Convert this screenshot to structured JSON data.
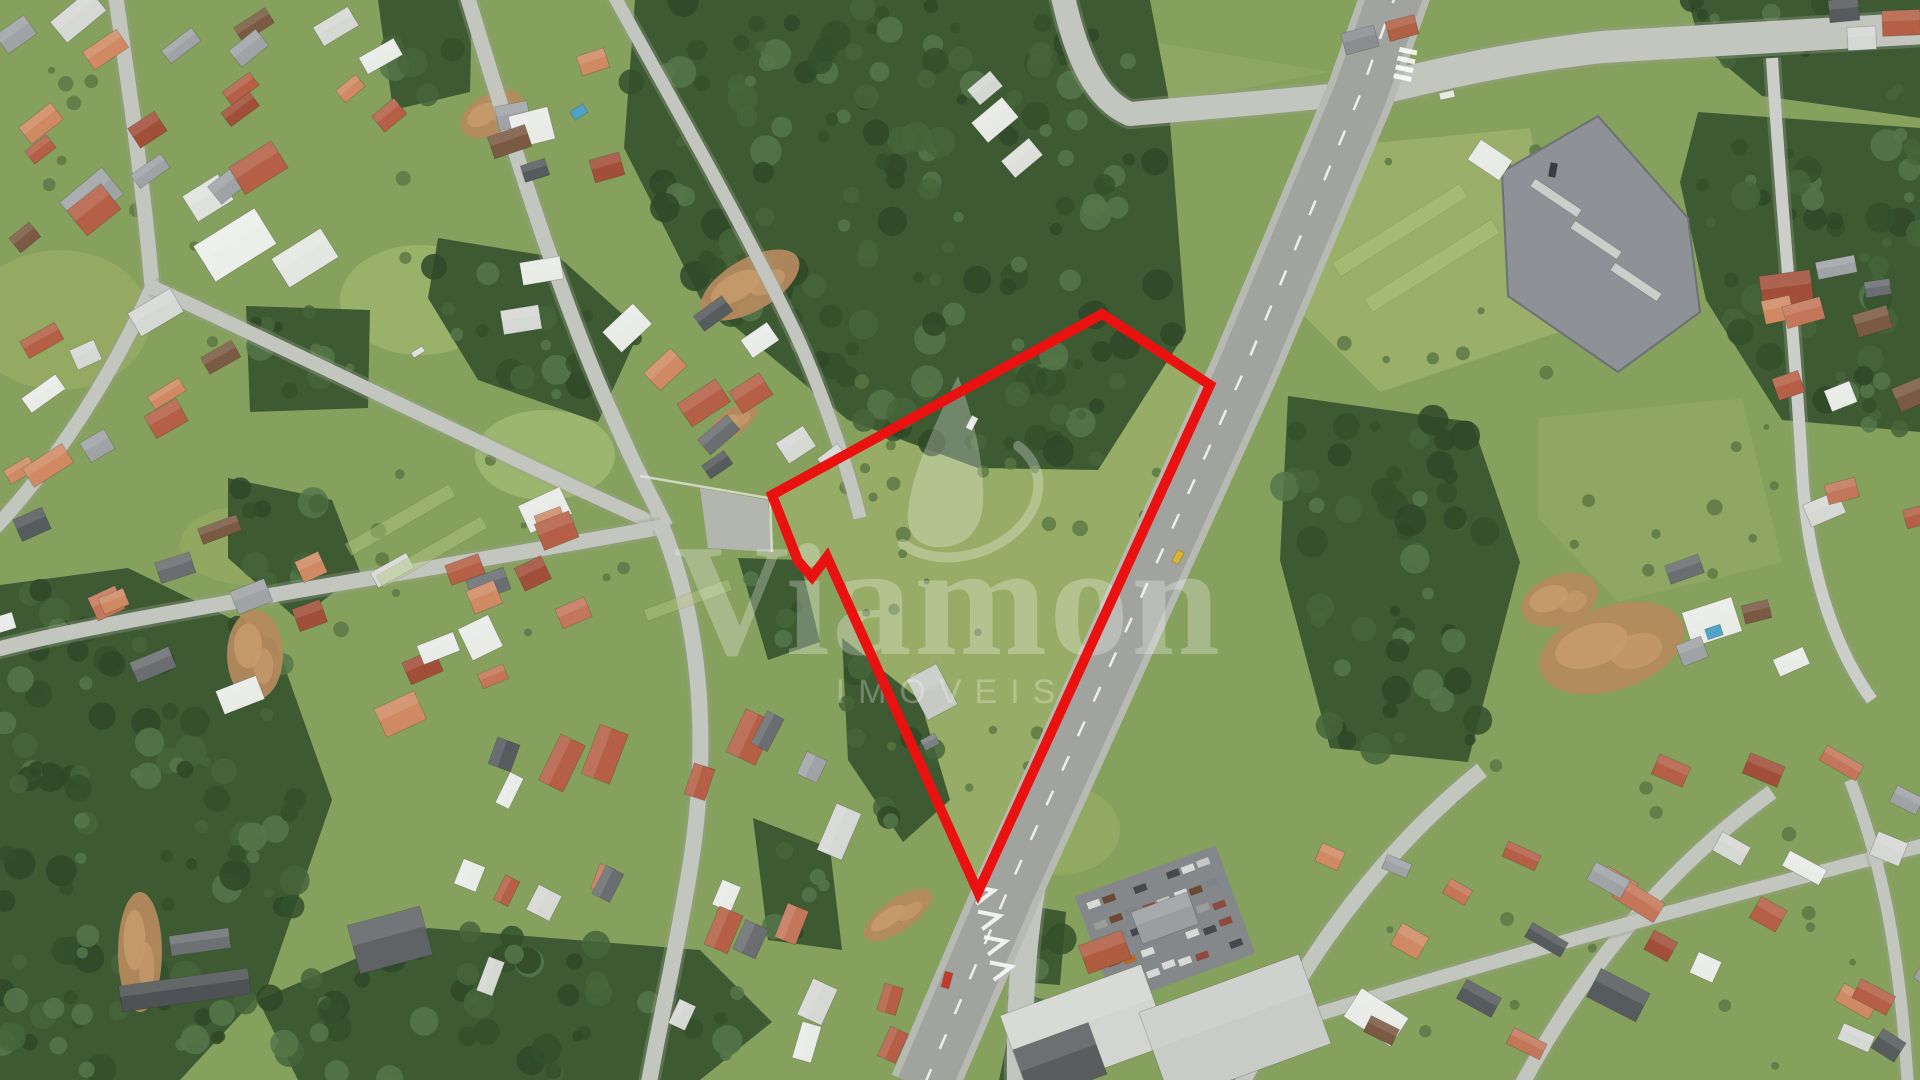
{
  "watermark": {
    "brand": "Viamon",
    "subtext": "IMÓVEIS",
    "color": "#ffffff",
    "opacity": 0.27
  },
  "boundary": {
    "color": "#ea1111",
    "stroke_width": 10,
    "points": [
      [
        1102,
        314
      ],
      [
        1210,
        385
      ],
      [
        978,
        892
      ],
      [
        827,
        557
      ],
      [
        812,
        577
      ],
      [
        798,
        561
      ],
      [
        772,
        495
      ]
    ]
  },
  "scene": {
    "base_color": "#86a05e",
    "forest_fill": "#3d5a33",
    "forest_texture": [
      "#2f4828",
      "#47653a",
      "#55774a",
      "#33502b"
    ],
    "road_color": "#c3c5bf",
    "highway_color": "#a1a49e",
    "highway_shoulder": "#b7bab2",
    "dirt_color": "#b78a5e",
    "dirt_light": "#c79b6c",
    "bush_color": "#5a7542",
    "house_palette": [
      "#b45f46",
      "#b45f46",
      "#c4765a",
      "#a14f38",
      "#e9ebe7",
      "#e9ebe7",
      "#d6d8d4",
      "#9fa3a5",
      "#6a6e71",
      "#565b5e",
      "#7a5a42",
      "#cf8a64"
    ],
    "car_palette": [
      "#d8d9d7",
      "#d8d9d7",
      "#c6c7c5",
      "#9c9d9b",
      "#8e4a3e",
      "#46494c",
      "#46494c",
      "#6b4a35",
      "#b4692e",
      "#7e8486"
    ],
    "fields": [
      {
        "use_boundary": true,
        "fill": "#97ad67"
      },
      {
        "pts": [
          [
            1300,
            150
          ],
          [
            1530,
            128
          ],
          [
            1565,
            330
          ],
          [
            1380,
            392
          ],
          [
            1288,
            300
          ]
        ],
        "fill": "#9ab06a"
      },
      {
        "pts": [
          [
            1538,
            418
          ],
          [
            1742,
            398
          ],
          [
            1782,
            562
          ],
          [
            1618,
            602
          ],
          [
            1538,
            518
          ]
        ],
        "fill": "#90a763"
      },
      {
        "pts": [
          [
            1072,
            28
          ],
          [
            1330,
            72
          ],
          [
            1140,
            108
          ]
        ],
        "fill": "#8fa765"
      },
      {
        "ellipse": [
          60,
          320,
          90,
          70
        ],
        "fill": "#96ab64"
      },
      {
        "ellipse": [
          420,
          300,
          80,
          55
        ],
        "fill": "#9cb26c"
      },
      {
        "ellipse": [
          545,
          455,
          70,
          45
        ],
        "fill": "#a0b871"
      },
      {
        "ellipse": [
          250,
          545,
          70,
          40
        ],
        "fill": "#93a862"
      },
      {
        "ellipse": [
          130,
          830,
          90,
          65
        ],
        "fill": "#8ea25f"
      },
      {
        "ellipse": [
          1060,
          830,
          60,
          45
        ],
        "fill": "#93aa63"
      }
    ],
    "forests": [
      {
        "pts": [
          [
            635,
            0
          ],
          [
            1150,
            0
          ],
          [
            1168,
            95
          ],
          [
            1186,
            332
          ],
          [
            1098,
            470
          ],
          [
            978,
            468
          ],
          [
            848,
            420
          ],
          [
            700,
            298
          ],
          [
            624,
            148
          ]
        ]
      },
      {
        "pts": [
          [
            1688,
            0
          ],
          [
            1920,
            0
          ],
          [
            1920,
            118
          ],
          [
            1762,
            96
          ],
          [
            1700,
            44
          ]
        ]
      },
      {
        "pts": [
          [
            1698,
            112
          ],
          [
            1920,
            128
          ],
          [
            1920,
            432
          ],
          [
            1782,
            420
          ],
          [
            1706,
            300
          ],
          [
            1680,
            182
          ]
        ]
      },
      {
        "pts": [
          [
            1288,
            396
          ],
          [
            1472,
            422
          ],
          [
            1520,
            562
          ],
          [
            1468,
            762
          ],
          [
            1330,
            748
          ],
          [
            1280,
            560
          ]
        ]
      },
      {
        "pts": [
          [
            0,
            585
          ],
          [
            128,
            568
          ],
          [
            275,
            640
          ],
          [
            332,
            800
          ],
          [
            268,
            985
          ],
          [
            180,
            1080
          ],
          [
            0,
            1080
          ]
        ]
      },
      {
        "pts": [
          [
            258,
            1000
          ],
          [
            428,
            928
          ],
          [
            700,
            950
          ],
          [
            772,
            1022
          ],
          [
            700,
            1080
          ],
          [
            298,
            1080
          ]
        ]
      },
      {
        "pts": [
          [
            842,
            638
          ],
          [
            920,
            700
          ],
          [
            950,
            800
          ],
          [
            903,
            842
          ],
          [
            848,
            760
          ]
        ]
      },
      {
        "pts": [
          [
            738,
            558
          ],
          [
            800,
            560
          ],
          [
            820,
            642
          ],
          [
            768,
            660
          ]
        ]
      },
      {
        "pts": [
          [
            753,
            818
          ],
          [
            830,
            848
          ],
          [
            842,
            950
          ],
          [
            768,
            940
          ]
        ]
      },
      {
        "pts": [
          [
            1026,
            905
          ],
          [
            1066,
            912
          ],
          [
            1060,
            985
          ],
          [
            1022,
            982
          ]
        ]
      },
      {
        "pts": [
          [
            1018,
            988
          ],
          [
            1062,
            1010
          ],
          [
            1056,
            1085
          ],
          [
            998,
            1085
          ]
        ]
      },
      {
        "pts": [
          [
            228,
            478
          ],
          [
            332,
            500
          ],
          [
            360,
            572
          ],
          [
            298,
            620
          ],
          [
            228,
            558
          ]
        ]
      },
      {
        "pts": [
          [
            438,
            238
          ],
          [
            560,
            258
          ],
          [
            640,
            330
          ],
          [
            598,
            422
          ],
          [
            478,
            380
          ],
          [
            428,
            298
          ]
        ]
      },
      {
        "pts": [
          [
            378,
            0
          ],
          [
            472,
            0
          ],
          [
            470,
            92
          ],
          [
            393,
            110
          ]
        ]
      },
      {
        "pts": [
          [
            246,
            306
          ],
          [
            370,
            310
          ],
          [
            368,
            408
          ],
          [
            250,
            412
          ]
        ]
      }
    ],
    "dirt": [
      [
        750,
        285,
        55,
        26,
        -30
      ],
      [
        255,
        655,
        28,
        45,
        0
      ],
      [
        140,
        952,
        22,
        60,
        0
      ],
      [
        1612,
        648,
        75,
        42,
        -18
      ],
      [
        898,
        915,
        40,
        16,
        -35
      ],
      [
        492,
        114,
        34,
        20,
        -30
      ],
      [
        733,
        422,
        28,
        13,
        -35
      ],
      [
        1560,
        600,
        40,
        25,
        -20
      ]
    ],
    "bush_zones": [
      [
        830,
        380,
        330,
        420,
        26
      ],
      [
        1300,
        140,
        260,
        260,
        12
      ],
      [
        1545,
        400,
        250,
        200,
        10
      ],
      [
        0,
        60,
        420,
        400,
        16
      ],
      [
        330,
        450,
        330,
        200,
        10
      ],
      [
        1250,
        750,
        650,
        320,
        16
      ]
    ],
    "roads": [
      {
        "d": "M612,-8 C660,80 730,200 788,318 C818,378 848,468 860,518",
        "w": 13
      },
      {
        "d": "M115,-8 C128,80 143,180 152,287",
        "w": 15
      },
      {
        "d": "M152,287 C112,375 58,460 -5,528",
        "w": 14
      },
      {
        "d": "M152,287 C280,345 480,445 662,527",
        "w": 14
      },
      {
        "d": "M466,-8 C505,120 558,298 618,428 C640,478 656,506 666,527",
        "w": 15
      },
      {
        "d": "M-5,650 C120,616 400,576 662,527",
        "w": 15
      },
      {
        "d": "M662,527 C700,622 712,742 688,880 C672,972 658,1030 648,1088",
        "w": 16
      },
      {
        "d": "M1772,58 C1782,220 1796,352 1802,470 C1807,560 1830,642 1872,700",
        "w": 12,
        "color": "#ccceca"
      },
      {
        "d": "M1240,1088 C1300,962 1380,852 1482,770",
        "w": 16
      },
      {
        "d": "M1520,1088 C1582,972 1662,872 1772,792",
        "w": 15
      },
      {
        "d": "M1228,1042 C1450,972 1700,902 1925,845",
        "w": 14
      },
      {
        "d": "M1850,780 C1882,862 1900,952 1908,1088",
        "w": 12
      },
      {
        "d": "M1062,-8 C1076,58 1096,100 1130,114 C1220,106 1300,100 1366,92",
        "w": 24
      },
      {
        "d": "M1366,92 C1446,72 1522,56 1602,47 L1925,28",
        "w": 32
      },
      {
        "d": "M1068,758 C1032,850 1018,948 1020,1088",
        "w": 26
      },
      {
        "d": "M1398,-12 L1360,95 L1243,373 L1008,890 L923,1088",
        "w": 54,
        "highway": true
      }
    ],
    "industrial": {
      "pts": [
        [
          1502,
          172
        ],
        [
          1598,
          116
        ],
        [
          1688,
          218
        ],
        [
          1700,
          312
        ],
        [
          1618,
          372
        ],
        [
          1508,
          296
        ]
      ],
      "fill": "#8e9297",
      "stroke": "#6d7175",
      "skylights": [
        [
          1556,
          198
        ],
        [
          1596,
          240
        ],
        [
          1636,
          282
        ]
      ],
      "canopy": [
        1490,
        160,
        38,
        24,
        34
      ]
    },
    "carlot": {
      "cx": 1165,
      "cy": 925,
      "w": 150,
      "h": 115,
      "angle": -20,
      "rows": 5,
      "cols": 8,
      "base": "#85888a"
    },
    "buildings": [
      [
        235,
        245,
        72,
        42,
        -32,
        "#eceee9"
      ],
      [
        305,
        258,
        58,
        34,
        -32,
        "#e4e6e1"
      ],
      [
        208,
        198,
        42,
        30,
        -32,
        "#dfe2dc"
      ],
      [
        545,
        510,
        46,
        30,
        -25,
        "#e9ebe7"
      ],
      [
        1712,
        622,
        52,
        36,
        -18,
        "#e9ebe7"
      ],
      [
        932,
        692,
        34,
        46,
        -28,
        "#c6c9c4"
      ],
      [
        930,
        742,
        16,
        12,
        -28,
        "#7b7f82"
      ],
      [
        1165,
        918,
        60,
        34,
        -20,
        "#9b9ea1"
      ],
      [
        1105,
        952,
        46,
        30,
        -20,
        "#b05c41"
      ],
      [
        1085,
        1030,
        150,
        85,
        -20,
        "#d2d5d0"
      ],
      [
        1235,
        1028,
        170,
        95,
        -20,
        "#c8cbc6"
      ],
      [
        1060,
        1062,
        80,
        55,
        -20,
        "#595d5f"
      ],
      [
        390,
        940,
        75,
        50,
        -15,
        "#5f6366"
      ],
      [
        185,
        990,
        130,
        26,
        -8,
        "#4e5254"
      ],
      [
        200,
        942,
        60,
        20,
        -8,
        "#6d7173"
      ],
      [
        995,
        120,
        40,
        26,
        -40,
        "#e7e9e4"
      ],
      [
        1022,
        158,
        36,
        22,
        -40,
        "#dcdfda"
      ],
      [
        985,
        88,
        30,
        20,
        -40,
        "#d4d7d2"
      ],
      [
        1360,
        40,
        34,
        22,
        -15,
        "#8a8e91"
      ],
      [
        1402,
        28,
        30,
        20,
        -15,
        "#b06044"
      ]
    ],
    "clusters": [
      [
        95,
        130,
        190,
        250,
        -35,
        11
      ],
      [
        300,
        115,
        210,
        190,
        -35,
        10
      ],
      [
        115,
        415,
        230,
        210,
        -30,
        10
      ],
      [
        165,
        592,
        330,
        150,
        -22,
        8
      ],
      [
        390,
        645,
        300,
        170,
        -25,
        9
      ],
      [
        560,
        180,
        170,
        280,
        -15,
        8
      ],
      [
        700,
        360,
        200,
        120,
        -38,
        6
      ],
      [
        775,
        452,
        150,
        60,
        -35,
        4
      ],
      [
        560,
        850,
        220,
        260,
        -68,
        10
      ],
      [
        762,
        880,
        170,
        300,
        -68,
        10
      ],
      [
        520,
        600,
        180,
        160,
        -25,
        7
      ],
      [
        1830,
        300,
        190,
        130,
        -12,
        6
      ],
      [
        1855,
        455,
        150,
        170,
        -20,
        6
      ],
      [
        1745,
        625,
        150,
        150,
        -20,
        4
      ],
      [
        1500,
        950,
        400,
        260,
        28,
        15
      ],
      [
        1760,
        850,
        300,
        190,
        28,
        10
      ],
      [
        1880,
        1012,
        120,
        140,
        28,
        5
      ],
      [
        1878,
        32,
        100,
        60,
        0,
        3
      ],
      [
        845,
        1032,
        140,
        90,
        -70,
        4
      ]
    ],
    "pavement": {
      "pts": [
        [
          700,
          488
        ],
        [
          768,
          500
        ],
        [
          772,
          552
        ],
        [
          708,
          548
        ]
      ],
      "fill": "#b3b6af"
    },
    "walls": [
      [
        640,
        476,
        768,
        498
      ],
      [
        770,
        500,
        772,
        552
      ]
    ],
    "stripes": [
      [
        400,
        520,
        120,
        14,
        -30
      ],
      [
        432,
        552,
        120,
        14,
        -30
      ],
      [
        1400,
        230,
        150,
        16,
        -32
      ],
      [
        1432,
        266,
        150,
        16,
        -32
      ],
      [
        688,
        600,
        90,
        12,
        -20
      ]
    ],
    "pools": [
      [
        579,
        112,
        15,
        10,
        -32
      ],
      [
        1714,
        632,
        16,
        11,
        -18
      ]
    ],
    "cars": [
      [
        947,
        980,
        16,
        8,
        -75,
        "#c6392b"
      ],
      [
        1447,
        95,
        15,
        7,
        -12,
        "#e8eae6"
      ],
      [
        1553,
        170,
        14,
        7,
        -80,
        "#3a3e41"
      ],
      [
        1178,
        557,
        13,
        7,
        -62,
        "#d8b72e"
      ],
      [
        972,
        423,
        14,
        7,
        -62,
        "#e6e8e4"
      ],
      [
        418,
        352,
        13,
        6,
        -32,
        "#dfe1dd"
      ]
    ],
    "chevrons": {
      "x": 988,
      "y": 892,
      "n": 4,
      "gap": 26,
      "angle": -13
    },
    "zebra": {
      "x": 1402,
      "y": 80,
      "n": 4,
      "angle": -78
    }
  }
}
